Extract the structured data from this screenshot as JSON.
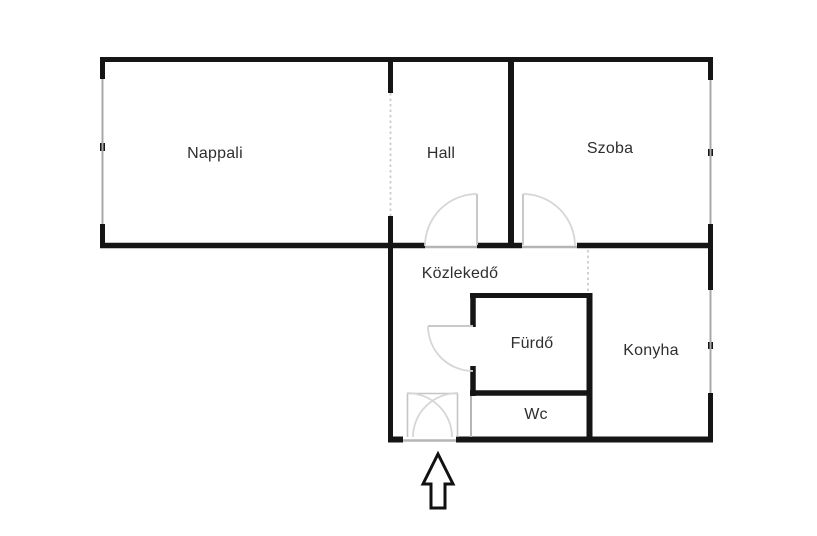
{
  "plan": {
    "type": "apartment-floor-plan",
    "language": "hu"
  },
  "rooms": {
    "nappali": {
      "label": "Nappali"
    },
    "hall": {
      "label": "Hall"
    },
    "szoba": {
      "label": "Szoba"
    },
    "kozlekedo": {
      "label": "Közlekedő"
    },
    "furdo": {
      "label": "Fürdő"
    },
    "konyha": {
      "label": "Konyha"
    },
    "wc": {
      "label": "Wc"
    }
  },
  "icons": {
    "entrance_arrow": "up-arrow-entrance-marker"
  },
  "colors": {
    "wall": "#151515",
    "window_line": "#a8a8a8",
    "threshold_line": "#b5b5b5",
    "door_leaf": "#c9c9c9",
    "door_arc": "#d6d6d6",
    "dashed_opening": "#cccccc",
    "label_text": "#2e2e2e",
    "background": "#ffffff"
  }
}
